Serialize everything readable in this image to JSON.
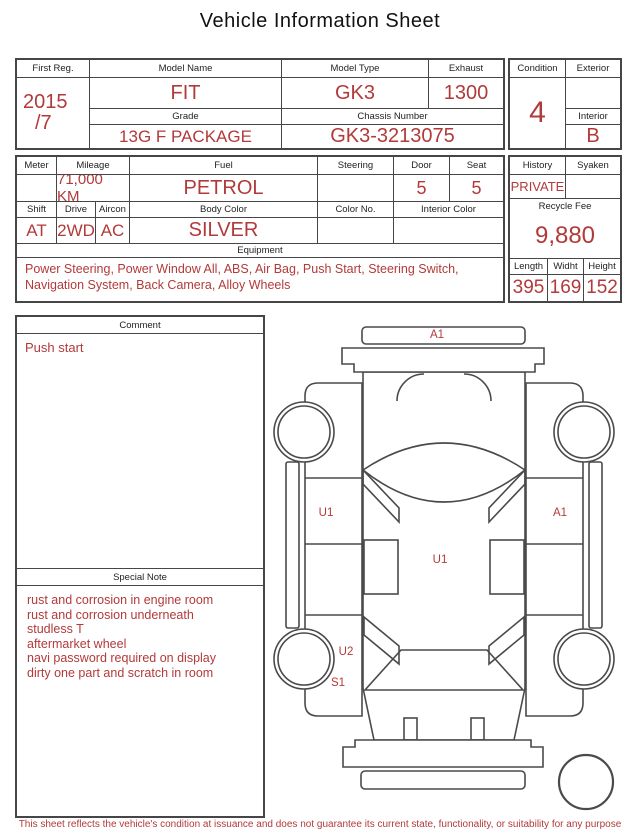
{
  "title": "Vehicle Information Sheet",
  "colors": {
    "accent_red": "#b23a3a",
    "border_dark": "#464646"
  },
  "section1": {
    "first_reg_label": "First Reg.",
    "first_reg_line1": "2015",
    "first_reg_line2": "/7",
    "model_name_label": "Model Name",
    "model_name": "FIT",
    "grade_label": "Grade",
    "grade": "13G F PACKAGE",
    "model_type_label": "Model Type",
    "model_type": "GK3",
    "exhaust_label": "Exhaust",
    "exhaust": "1300",
    "chassis_number_label": "Chassis Number",
    "chassis_number": "GK3-3213075",
    "condition_label": "Condition",
    "condition": "4",
    "exterior_label": "Exterior",
    "exterior": "",
    "interior_label": "Interior",
    "interior": "B"
  },
  "section2": {
    "meter_label": "Meter",
    "meter": "",
    "mileage_label": "Mileage",
    "mileage": "71,000 KM",
    "fuel_label": "Fuel",
    "fuel": "PETROL",
    "steering_label": "Steering",
    "steering": "",
    "door_label": "Door",
    "door": "5",
    "seat_label": "Seat",
    "seat": "5",
    "shift_label": "Shift",
    "shift": "AT",
    "drive_label": "Drive",
    "drive": "2WD",
    "aircon_label": "Aircon",
    "aircon": "AC",
    "body_color_label": "Body Color",
    "body_color": "SILVER",
    "color_no_label": "Color No.",
    "color_no": "",
    "interior_color_label": "Interior Color",
    "interior_color": "",
    "equipment_label": "Equipment",
    "equipment": "Power Steering, Power Window All, ABS, Air Bag, Push Start, Steering Switch, Navigation System, Back Camera, Alloy Wheels",
    "history_label": "History",
    "history": "PRIVATE",
    "syaken_label": "Syaken",
    "syaken": "",
    "recycle_fee_label": "Recycle Fee",
    "recycle_fee": "9,880",
    "length_label": "Length",
    "length": "395",
    "width_label": "Widht",
    "width": "169",
    "height_label": "Height",
    "height": "152"
  },
  "comment": {
    "label": "Comment",
    "text": "Push start",
    "special_note_label": "Special Note",
    "special_notes": [
      "rust and corrosion in engine room",
      "rust and corrosion underneath",
      "studless T",
      "aftermarket wheel",
      "navi password required on display",
      "dirty one part and scratch in room"
    ]
  },
  "diagram": {
    "front_bumper_mark": "A1",
    "left_front_door_mark": "U1",
    "right_front_door_mark": "A1",
    "cabin_mark": "U1",
    "left_rear_door_mark": "U2",
    "left_rear_sill_mark": "S1"
  },
  "footer": "This sheet reflects the vehicle's condition at issuance and does not guarantee its current state, functionality, or suitability for any purpose"
}
